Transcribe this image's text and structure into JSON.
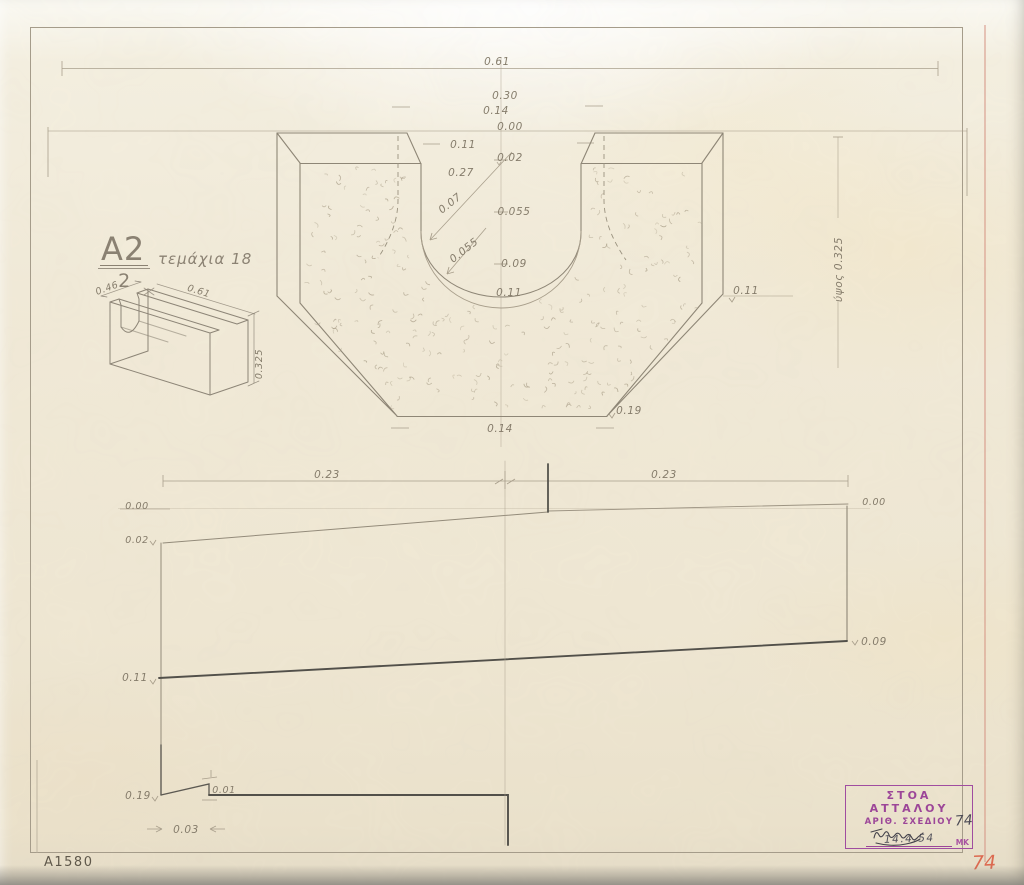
{
  "document": {
    "type_label": "construction drawing",
    "catalog_number": "A1580",
    "corner_number_red": "74"
  },
  "title_block": {
    "piece_code": "A2",
    "piece_denominator": "2",
    "pieces_note": "τεμάχια 18"
  },
  "stamp": {
    "line1": "ΣΤΟΑ ΑΤΤΑΛΟΥ",
    "line2": "ΑΡΙΘ. ΣΧΕΔΙΟΥ",
    "drawing_number": "74",
    "date": "14.4.54",
    "initials": "ΜΚ"
  },
  "section_view": {
    "overall_width": "0.61",
    "mouth_width_top": "0.30",
    "mouth_width_mid": "0.14",
    "level_zero": "0.00",
    "lip_width": "0.11",
    "depth_02": "0.02",
    "width_27": "0.27",
    "radial_07": "0.07",
    "depth_055": "0.055",
    "radial_055": "0.055",
    "depth_09": "0.09",
    "depth_11": "0.11",
    "bottom_width": "0.14",
    "corner_depth": "0.19",
    "right_level_11": "0.11",
    "height_note": "ύψος 0.325"
  },
  "profile_view": {
    "span_left": "0.23",
    "span_right": "0.23",
    "left_level_00": "0.00",
    "left_level_02": "0.02",
    "left_level_11": "0.11",
    "left_level_19": "0.19",
    "right_level_00": "0.00",
    "right_level_09": "0.09",
    "step_01": "0.01",
    "width_03": "0.03"
  },
  "iso_sketch": {
    "width": "0.46",
    "length": "0.61",
    "height": "0.325"
  },
  "colors": {
    "stamp_purple": "#9c4698",
    "red_accent": "#dc6a50",
    "pencil": "#8e8676",
    "pencil_dark": "#52504a",
    "paper": "#f1ead8"
  }
}
